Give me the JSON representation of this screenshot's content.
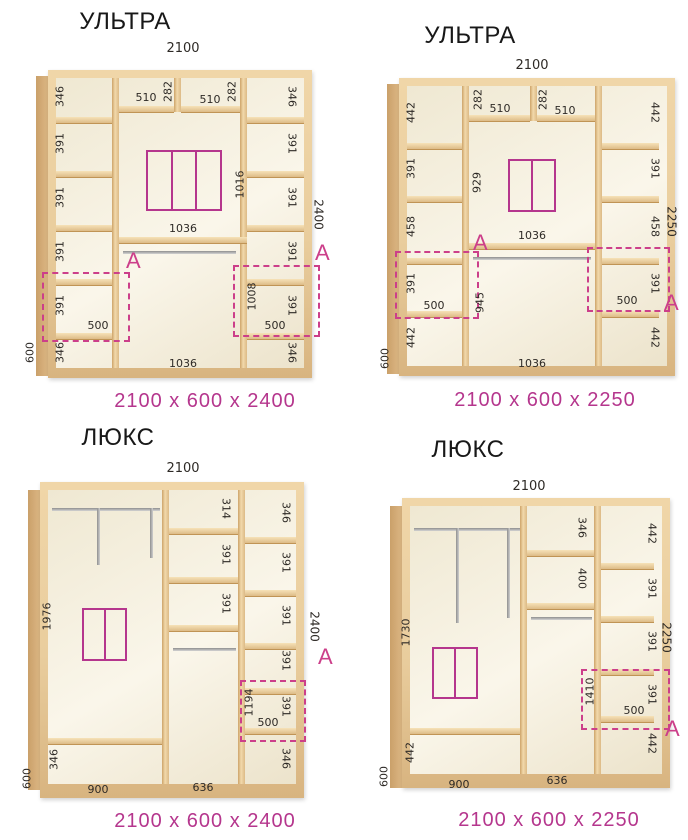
{
  "palette": {
    "accent_pink": "#cc3f8a",
    "caption_pink": "#b5368d",
    "wood_face": "#e9cd9d",
    "wood_edge": "#caa06a",
    "interior_cream": "#f7f2e2",
    "number_text": "#2e2a26"
  },
  "wardrobes": [
    {
      "title": "УЛЬТРА",
      "caption": "2100 x 600 x 2400",
      "width": "2100",
      "height": "2400",
      "depth": "600",
      "zone": "A",
      "left_cells": [
        "346",
        "391",
        "391",
        "391",
        "391",
        "346"
      ],
      "left_shelf": "500",
      "right_cells": [
        "346",
        "391",
        "391",
        "391",
        "391",
        "346"
      ],
      "right_shelf": "500",
      "right_zone_height": "1008",
      "top_widths": [
        "510",
        "510"
      ],
      "top_heights": [
        "282",
        "282"
      ],
      "mid_upper_height": "1016",
      "mid_shelf_width": "1036",
      "mid_bottom_width": "1036"
    },
    {
      "title": "УЛЬТРА",
      "caption": "2100 x 600 x 2250",
      "width": "2100",
      "height": "2250",
      "depth": "600",
      "zone": "A",
      "left_cells": [
        "442",
        "391",
        "458",
        "391",
        "442"
      ],
      "left_shelf": "500",
      "right_cells": [
        "442",
        "391",
        "458",
        "391",
        "442"
      ],
      "right_shelf": "500",
      "top_widths": [
        "510",
        "510"
      ],
      "top_heights": [
        "282",
        "282"
      ],
      "mid_upper_height": "929",
      "mid_lower_height": "945",
      "mid_shelf_width": "1036",
      "mid_bottom_width": "1036"
    },
    {
      "title": "ЛЮКС",
      "caption": "2100 x 600 x 2400",
      "width": "2100",
      "height": "2400",
      "depth": "600",
      "zone": "A",
      "left_section_height": "1976",
      "left_bottom_cell": "346",
      "left_bottom_width": "900",
      "mid_cells": [
        "314",
        "391",
        "391"
      ],
      "mid_bottom_width": "636",
      "right_cells": [
        "346",
        "391",
        "391",
        "391",
        "391",
        "346"
      ],
      "right_shelf": "500",
      "right_zone_height": "1194"
    },
    {
      "title": "ЛЮКС",
      "caption": "2100 x 600 x 2250",
      "width": "2100",
      "height": "2250",
      "depth": "600",
      "zone": "A",
      "left_section_height": "1730",
      "left_bottom_cell": "442",
      "left_bottom_width": "900",
      "mid_cells": [
        "346",
        "400"
      ],
      "mid_bottom_width": "636",
      "right_cells": [
        "442",
        "391",
        "391",
        "391",
        "442"
      ],
      "right_shelf": "500",
      "right_zone_height": "1410"
    }
  ]
}
